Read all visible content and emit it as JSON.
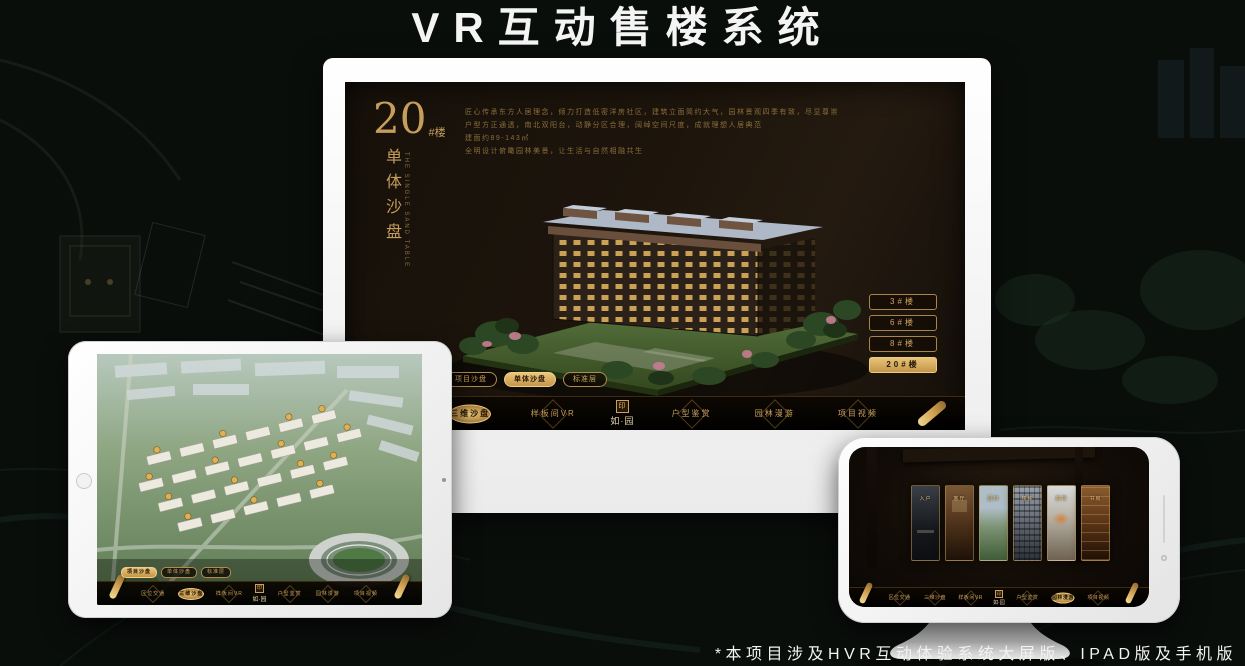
{
  "title": "VR互动售楼系统",
  "footnote": "*本项目涉及HVR互动体验系统大屏版、IPAD版及手机版",
  "colors": {
    "accent_gold": "#cfa35f",
    "active_gold": "#e9c378",
    "screen_bg": "#1a130c"
  },
  "view_tabs": [
    {
      "label": "项目沙盘"
    },
    {
      "label": "单体沙盘"
    },
    {
      "label": "标准层"
    }
  ],
  "menu": {
    "logo": "如·园",
    "logo_seal": "印",
    "items": [
      {
        "label": "区位交通"
      },
      {
        "label": "三维沙盘"
      },
      {
        "label": "样板间VR"
      },
      {
        "label": "户型鉴赏"
      },
      {
        "label": "园林漫游"
      },
      {
        "label": "项目视频"
      }
    ]
  },
  "desktop": {
    "block": {
      "number": "20",
      "suffix": "#楼",
      "subtitle": "单体沙盘",
      "subtitle_en": "THE SINGLE SAND TABLE"
    },
    "description_lines": [
      "匠心传承东方人居理念，倾力打造低密洋房社区，建筑立面简约大气，园林景观四季有致，尽显尊崇气度",
      "户型方正通透，南北双阳台，动静分区合理，阔绰空间尺度，成就理想人居典范",
      "建面约89-143㎡",
      "全明设计俯瞰园林美景，让生活与自然相融共生"
    ],
    "building_buttons": [
      {
        "label": "3#楼"
      },
      {
        "label": "6#楼"
      },
      {
        "label": "8#楼"
      },
      {
        "label": "20#楼"
      }
    ]
  },
  "phone": {
    "panels": [
      {
        "label": "入户"
      },
      {
        "label": "客厅"
      },
      {
        "label": "园林"
      },
      {
        "label": "楼栋"
      },
      {
        "label": "庭院"
      },
      {
        "label": "书房"
      }
    ]
  }
}
